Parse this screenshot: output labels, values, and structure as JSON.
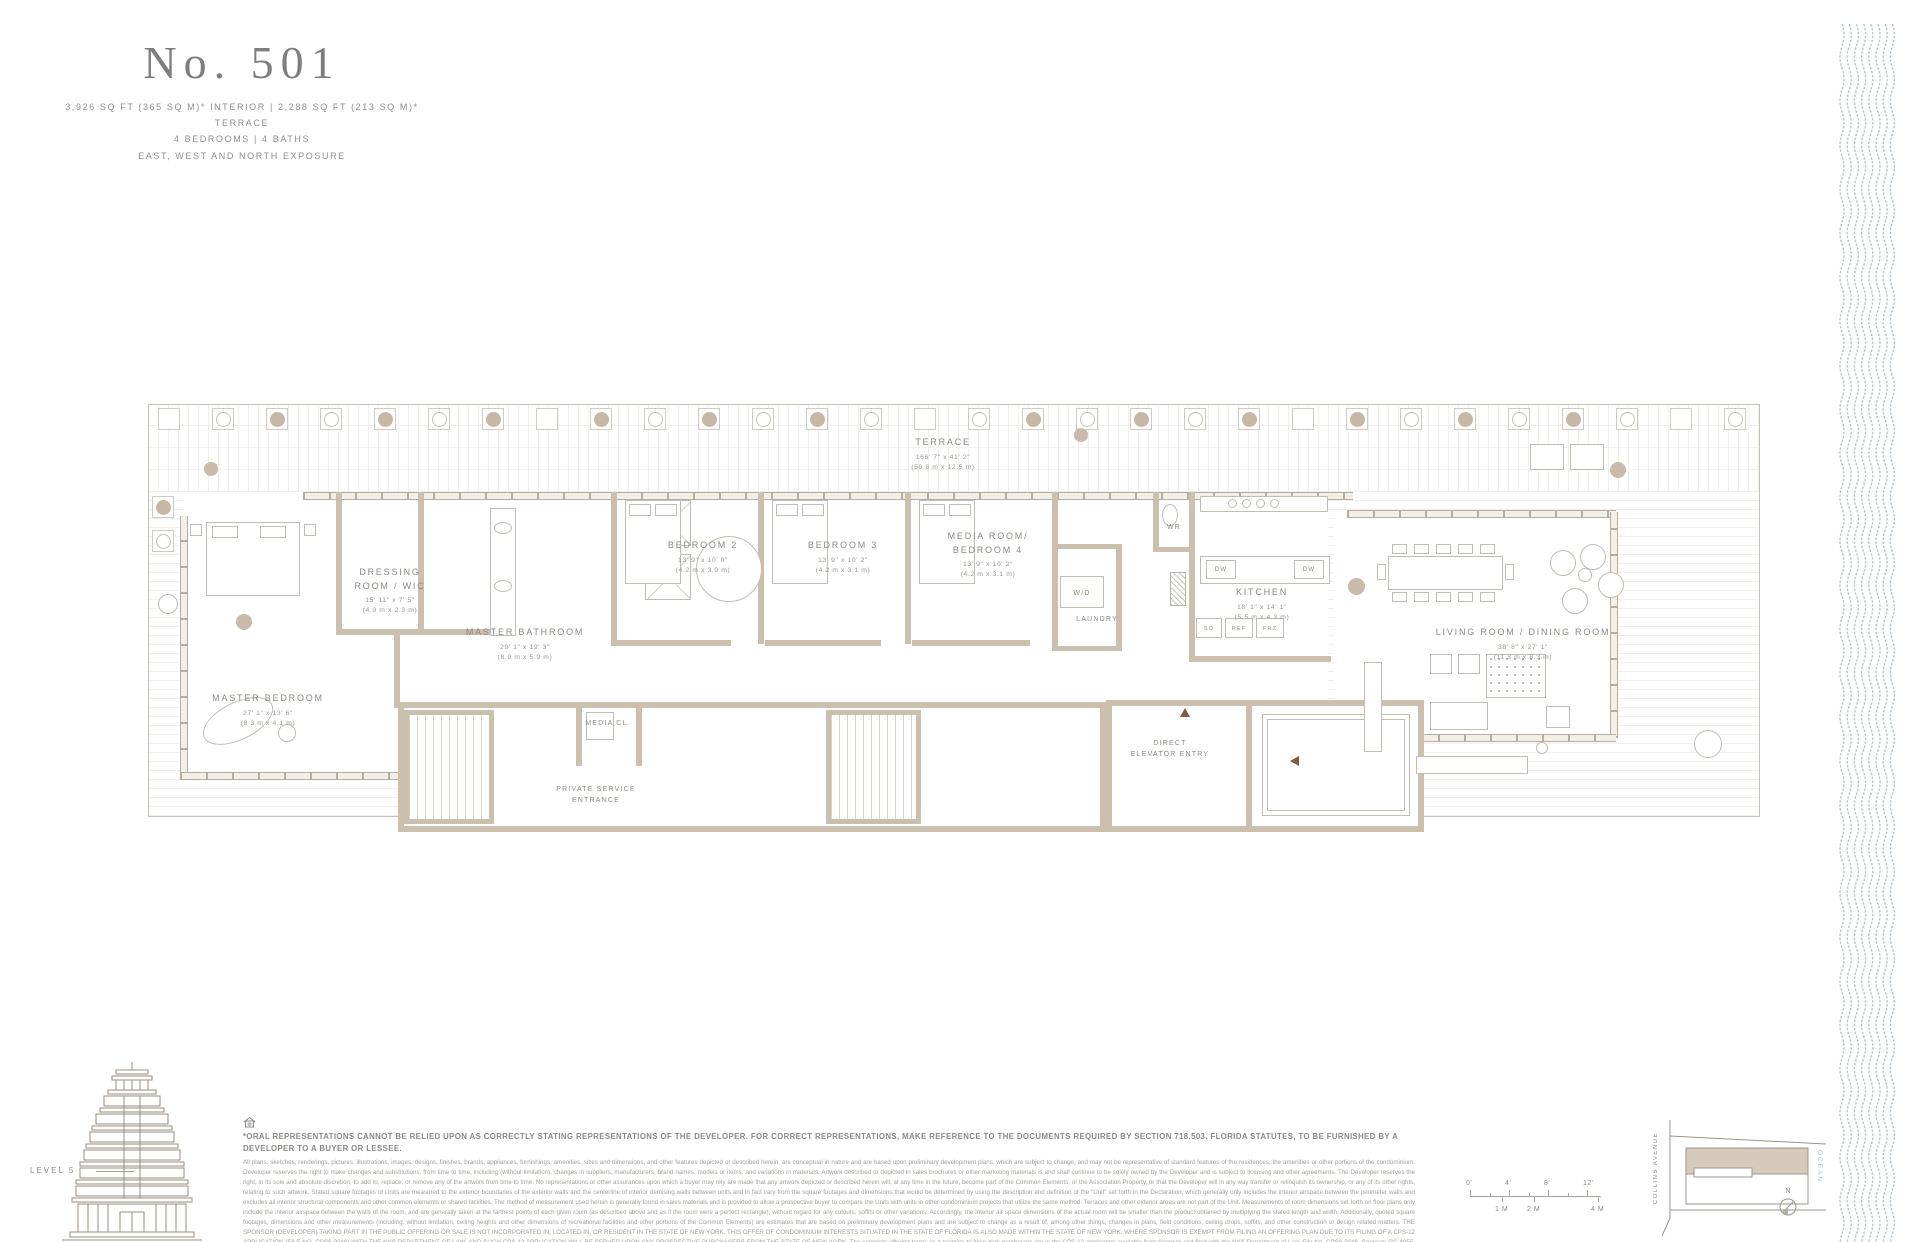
{
  "header": {
    "unit": "No. 501",
    "specs1": "3,926 SQ FT (365 SQ M)* INTERIOR  |  2,288 SQ FT (213 SQ M)* TERRACE",
    "specs2": "4 BEDROOMS  |  4 BATHS",
    "specs3": "EAST, WEST AND NORTH EXPOSURE"
  },
  "plan": {
    "terrace": {
      "name": "TERRACE",
      "ft": "166' 7\" x 41' 2\"",
      "m": "(50.8 m x 12.5 m)"
    },
    "rooms": [
      {
        "name": "DRESSING\nROOM / WIC",
        "ft": "15' 11\" x 7' 5\"",
        "m": "(4.9 m x 2.3 m)"
      },
      {
        "name": "MASTER BATHROOM",
        "ft": "29' 1\" x 19' 3\"",
        "m": "(8.9 m x 5.9 m)"
      },
      {
        "name": "MASTER BEDROOM",
        "ft": "27' 1\" x 13' 6\"",
        "m": "(8.3 m x 4.1 m)"
      },
      {
        "name": "BEDROOM 2",
        "ft": "13' 9\" x 10' 0\"",
        "m": "(4.2 m x 3.0 m)"
      },
      {
        "name": "BEDROOM 3",
        "ft": "13' 9\" x 10' 2\"",
        "m": "(4.2 m x 3.1 m)"
      },
      {
        "name": "MEDIA ROOM/\nBEDROOM 4",
        "ft": "13' 9\" x 10' 2\"",
        "m": "(4.2 m x 3.1 m)"
      },
      {
        "name": "KITCHEN",
        "ft": "18' 1\" x 14' 1\"",
        "m": "(5.5 m x 4.3 m)"
      },
      {
        "name": "LIVING ROOM / DINING ROOM",
        "ft": "38' 8\" x 27' 1\"",
        "m": "(11.8 m x 8.3 m)"
      }
    ],
    "labels": {
      "wd": "W/D",
      "laundry": "LAUNDRY",
      "wr": "WR",
      "dw": "DW",
      "so": "SO",
      "ref": "REF",
      "frz": "FRZ",
      "media_cl": "MEDIA CL.",
      "service": "PRIVATE SERVICE ENTRANCE",
      "elevator": "DIRECT ELEVATOR ENTRY"
    },
    "planter_count": 30
  },
  "level": {
    "label": "LEVEL 5"
  },
  "key_plan": {
    "street": "COLLINS AVENUE",
    "ocean": "OCEAN",
    "north": "N"
  },
  "scale_bar": {
    "ft": [
      {
        "t": "0'",
        "x": 0
      },
      {
        "t": "4'",
        "x": 39
      },
      {
        "t": "8'",
        "x": 78
      },
      {
        "t": "12'",
        "x": 117
      }
    ],
    "m": [
      {
        "t": "1 M",
        "x": 32
      },
      {
        "t": "2 M",
        "x": 64
      },
      {
        "t": "4 M",
        "x": 128
      }
    ]
  },
  "disclaimer": {
    "bold": "*ORAL REPRESENTATIONS CANNOT BE RELIED UPON AS CORRECTLY STATING REPRESENTATIONS OF THE DEVELOPER. FOR CORRECT REPRESENTATIONS, MAKE REFERENCE TO THE DOCUMENTS REQUIRED BY SECTION 718.503, FLORIDA STATUTES, TO BE FURNISHED BY A DEVELOPER TO A BUYER OR LESSEE.",
    "fine": "All plans, sketches, renderings, pictures, illustrations, images, designs, finishes, brands, appliances, furnishings, amenities, sizes and dimensions, and other features depicted or described herein, are conceptual in nature and are based upon preliminary development plans, which are subject to change, and may not be representative of standard features of the residences, the amenities or other portions of the condominium. Developer reserves the right to make changes and substitutions, from time to time, including (without limitation), changes in suppliers, manufacturers, brand names, models or items, and variations in materials. Artwork described or depicted in sales brochures or other marketing materials is and shall continue to be solely owned by the Developer and is subject to licensing and other agreements. The Developer reserves the right, in its sole and absolute discretion, to add to, replace, or remove any of the artwork from time to time. No representations or other assurances upon which a buyer may rely are made that any artwork depicted or described herein will, at any time in the future, become part of the Common Elements, or the Association Property, or that the Developer will in any way transfer or relinquish its ownership, or any of its other rights, relating to such artwork. Stated square footages of Units are measured to the exterior boundaries of the exterior walls and the centerline of interior demising walls between units and in fact vary from the square footages and dimensions that would be determined by using the description and definition of the \"Unit\" set forth in the Declaration, which generally only includes the interior airspace between the perimeter walls and excludes all interior structural components and other common elements or shared facilities. The method of measurement used herein is generally found in sales materials and is provided to allow a prospective buyer to compare the Units with units in other condominium projects that utilize the same method. Terraces and other exterior areas are not part of the Unit. Measurements of room dimensions set forth on floor plans only include the interior airspace between the walls of the room, and are generally taken at the farthest points of each given room (as described above and as if the room were a perfect rectangle), without regard for any cutouts, soffits or other variations. Accordingly, the interior air space dimensions of the actual room will be smaller than the product obtained by multiplying the stated length and width. Additionally, quoted square footages, dimensions and other measurements (including, without limitation, ceiling heights and other dimensions of recreational facilities and other portions of the Common Elements) are estimates that are based on preliminary development plans and are subject to change as a result of, among other things, changes in plans, field conditions, ceiling drops, soffits, and other construction or design related matters. THE SPONSOR (DEVELOPER) TAKING PART IN THE PUBLIC OFFERING OR SALE IS NOT INCORPORATED IN, LOCATED IN, OR RESIDENT IN THE STATE OF NEW YORK. THIS OFFER OF CONDOMINIUM INTERESTS SITUATED IN THE STATE OF FLORIDA IS ALSO MADE WITHIN THE STATE OF NEW YORK, WHERE SPONSOR IS EXEMPT FROM FILING AN OFFERING PLAN DUE TO ITS FILING OF A CPS-12 APPLICATION (FILE NO. CPS6-0046) WITH THE NYS DEPARTMENT OF LAW, AND SUCH CPS-12 APPLICATION WILL BE SERVED UPON ANY PROSPECTIVE PURCHASERS FROM THE STATE OF NEW YORK. The complete offering terms as it pertains to New York purchasers are in the CPS-12 application available from Sponsor and filed with the NYS Department of Law, File No. CPS6-0046. Sponsor: GC 8955, LLC, 9/11 Cabrini Ct., Somerville, SC, 29485. © ARTE GC 8955 LLC. ARTE logo is a registered trademark of GC 8955 LLC. All rights reserved."
  },
  "colors": {
    "wall": "#cbbfae",
    "label": "#8e8881",
    "wave": "#b3c7d5",
    "title": "#7d7e82"
  }
}
